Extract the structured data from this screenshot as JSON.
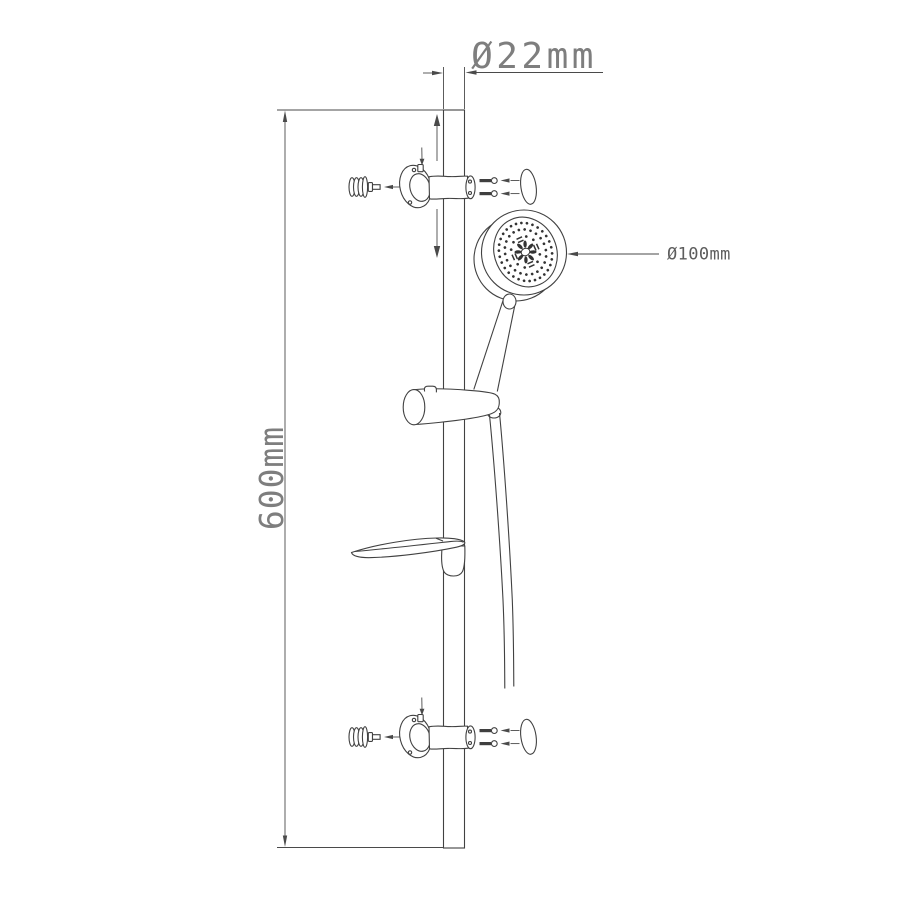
{
  "drawing": {
    "type": "technical line drawing",
    "subject": "shower slide rail set (exploded installation view)",
    "background_color": "#ffffff",
    "line_color": "#414141",
    "text_color": "#7e7e7e"
  },
  "dimensions": {
    "rail_diameter": "Ø22mm",
    "rail_length": "600mm",
    "head_diameter": "Ø100mm"
  },
  "parts": [
    "slide-rail",
    "top-wall-bracket",
    "bottom-wall-bracket",
    "wall-anchor",
    "mounting-screw",
    "fixing-screws",
    "oval-cover-ring",
    "shower-head",
    "shower-handle",
    "slider-holder",
    "shower-hose",
    "soap-dish"
  ]
}
